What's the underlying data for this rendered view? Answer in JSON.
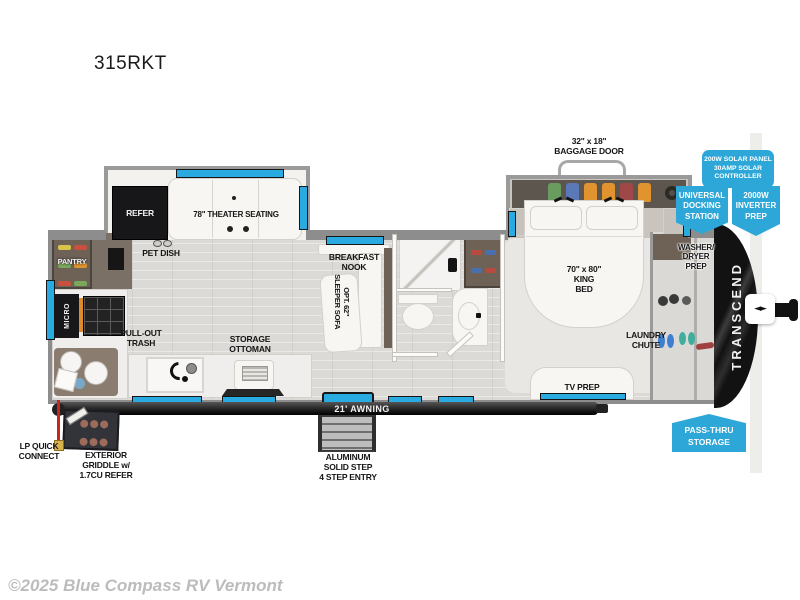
{
  "title": "315RKT",
  "watermark": "©2025 Blue Compass RV Vermont",
  "colors": {
    "badge": "#2da7d8",
    "window": "#29abe2"
  },
  "badges": {
    "solar": "200W SOLAR PANEL\n30AMP SOLAR\nCONTROLLER",
    "docking": "UNIVERSAL\nDOCKING\nSTATION",
    "inverter": "2000W\nINVERTER\nPREP",
    "passthru": "PASS-THRU\nSTORAGE"
  },
  "labels": {
    "baggage_door": "32\" x 18\"\nBAGGAGE DOOR",
    "king_bed": "70\" x 80\"\nKING\nBED",
    "laundry_chute": "LAUNDRY\nCHUTE",
    "tv_prep": "TV PREP",
    "washer_dryer": "WASHER/\nDRYER\nPREP",
    "transcend": "TRANSCEND",
    "refer": "REFER",
    "theater": "78\" THEATER SEATING",
    "pet_dish": "PET DISH",
    "pantry": "PANTRY",
    "micro": "MICRO",
    "pull_out_trash": "PULL-OUT\nTRASH",
    "storage_ottoman": "STORAGE\nOTTOMAN",
    "breakfast_nook": "BREAKFAST\nNOOK",
    "sleeper_sofa": "OPT. 62\"\nSLEEPER SOFA",
    "awning": "21' AWNING",
    "steps": "ALUMINUM\nSOLID STEP\n4 STEP ENTRY",
    "lp_connect": "LP QUICK\nCONNECT",
    "griddle": "EXTERIOR\nGRIDDLE w/\n1.7CU REFER"
  }
}
